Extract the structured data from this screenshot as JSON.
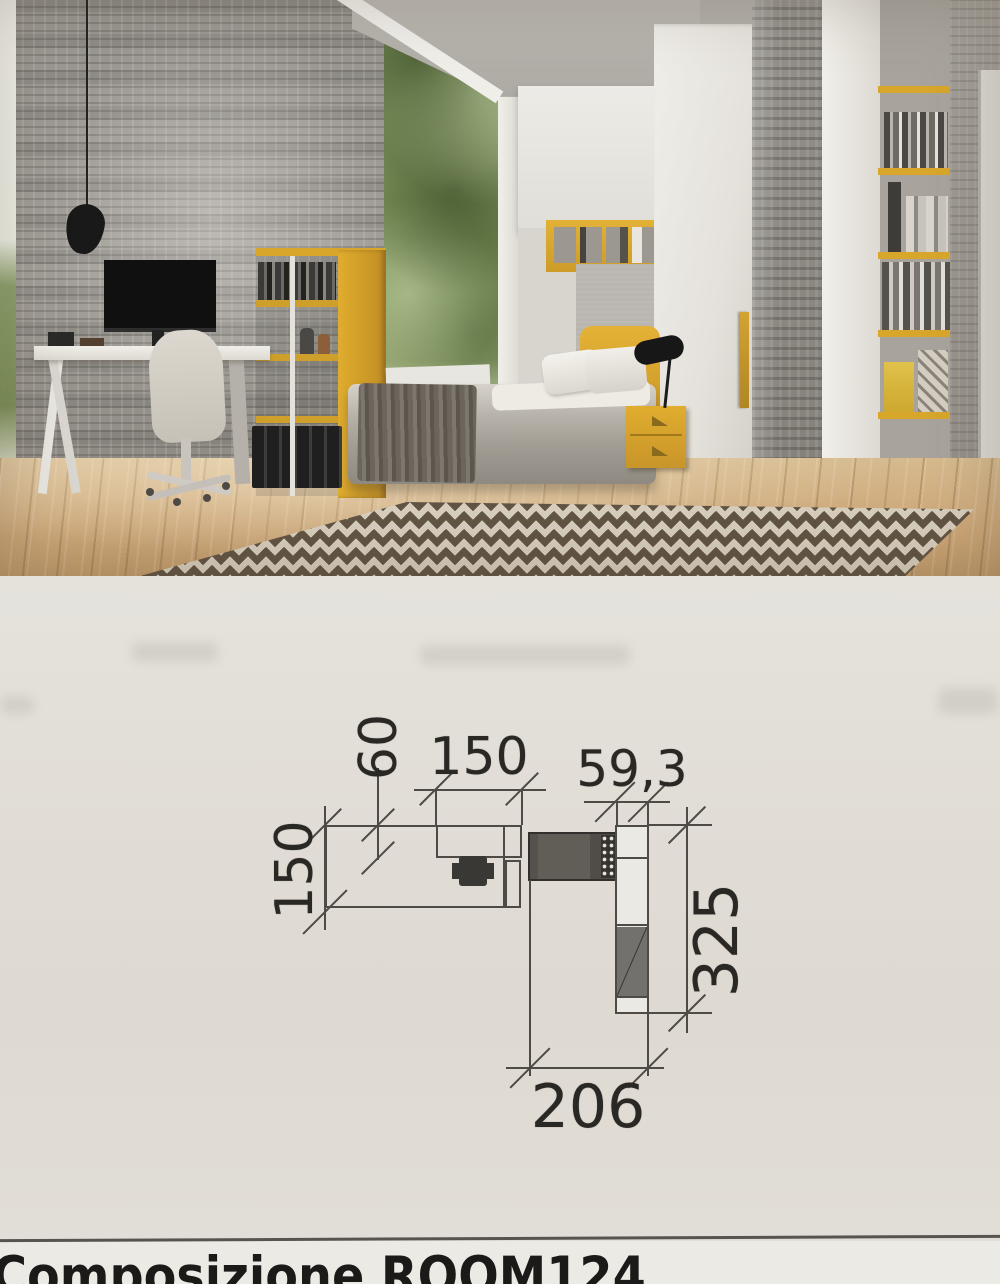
{
  "footer": {
    "title": "Composizione ROOM124"
  },
  "plan": {
    "labels": {
      "top_depth": "60",
      "top_width": "150",
      "left_height": "150",
      "wardrobe_width": "59,3",
      "right_height": "325",
      "bottom_width": "206"
    }
  },
  "colors": {
    "accent_yellow": "#d9a62c",
    "paper": "#e6e4df",
    "plan_line": "#4e4b47",
    "plan_text": "#2a2824",
    "title_text": "#1b1a18"
  }
}
